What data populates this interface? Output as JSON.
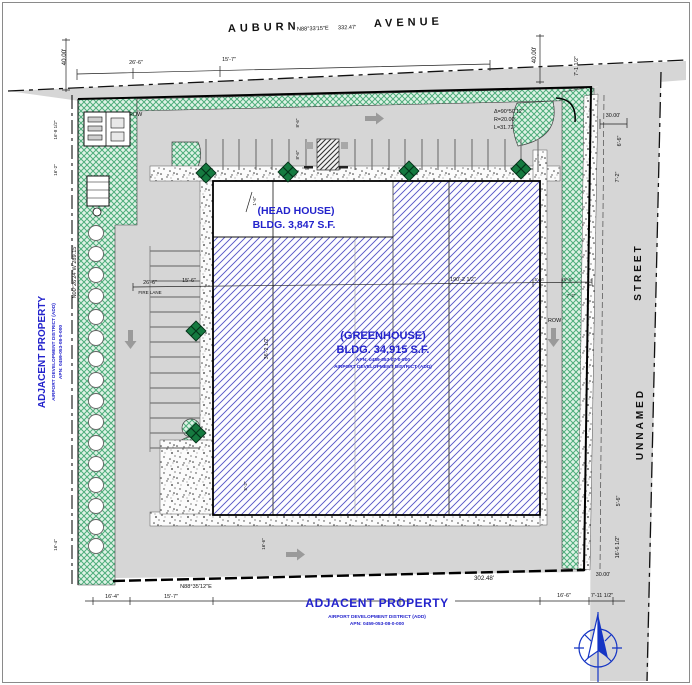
{
  "colors": {
    "pavement": "#d6d6d6",
    "landscape_green": "#7ed0a0",
    "hatch_blue": "#5252c4",
    "label_blue": "#2323cc",
    "tree_green": "#157a40",
    "compass_blue": "#1535c4"
  },
  "streets": {
    "auburn": {
      "word_left": "AUBURN",
      "word_right": "AVENUE",
      "bearing": "N88°33'15\"E",
      "distance": "332.47'"
    },
    "unnamed": {
      "word_top": "STREET",
      "word_bottom": "UNNAMED"
    }
  },
  "boundary": {
    "west": {
      "bearing_distance": "N00°26'24\"W   289.15'"
    },
    "south": {
      "bearing": "N88°35'12\"E",
      "distance": "302.48'"
    }
  },
  "buildings": {
    "head_house": {
      "name": "(HEAD HOUSE)",
      "area": "BLDG. 3,847 S.F."
    },
    "greenhouse": {
      "name": "(GREENHOUSE)",
      "area": "BLDG. 34,915 S.F.",
      "apn": "APN:  0459-053-07-0-000",
      "district": "AIRPORT DEVELOPMENT DISTRICT (ADD)"
    }
  },
  "adjacent_west": {
    "title": "ADJACENT PROPERTY",
    "district": "AIRPORT DEVELOPMENT DISTRICT (ADD)",
    "apn": "APN:  0459-053-08-0-000"
  },
  "adjacent_south": {
    "title": "ADJACENT PROPERTY",
    "district": "AIRPORT DEVELOPMENT DISTRICT (ADD)",
    "apn": "APN:  0459-053-08-0-000"
  },
  "curve": {
    "delta": "Δ=90°50'12\"",
    "radius": "R=20.00'",
    "length": "L=31.72'"
  },
  "labels": {
    "row_west": "ROW",
    "row_east": "ROW",
    "fire_lane": "FIRE LANE"
  },
  "dims": {
    "w40_nw": "40.00'",
    "w40_ne": "40.00'",
    "n26_6": "26'-6\"",
    "n15_7": "15'-7\"",
    "e7_1h": "7'-1 1/2\"",
    "e30_ne": "30.00'",
    "e6_6": "6'-6\"",
    "e7_2": "7'-2\"",
    "e5_6": "5'-6\"",
    "e16_6h": "16'-6 1/2\"",
    "e30_se": "30.00'",
    "s16_6": "16'-6\"",
    "s7_11h": "7'-11 1/2\"",
    "s16_4": "16'-4\"",
    "s15_7": "15'-7\"",
    "mid26_6": "26'-6\"",
    "mid15_6": "15'-6\"",
    "mid190": "190'-2 1/2\"",
    "mid36": "36'-2 1/2\"",
    "r5_6": "5'-6\"",
    "r26_6": "26'-6\"",
    "r7_2": "7'-2\"",
    "stall8_6a": "8'-6\"",
    "stall8_6b": "8'-6\"",
    "hh1_6": "1'-6\"",
    "b5_2": "5'-2\"",
    "b16_6": "16'-6\"",
    "nw16_8h": "16'-8 1/2\"",
    "nw16_2": "16'-2\"",
    "sw16_4": "16'-4\""
  }
}
